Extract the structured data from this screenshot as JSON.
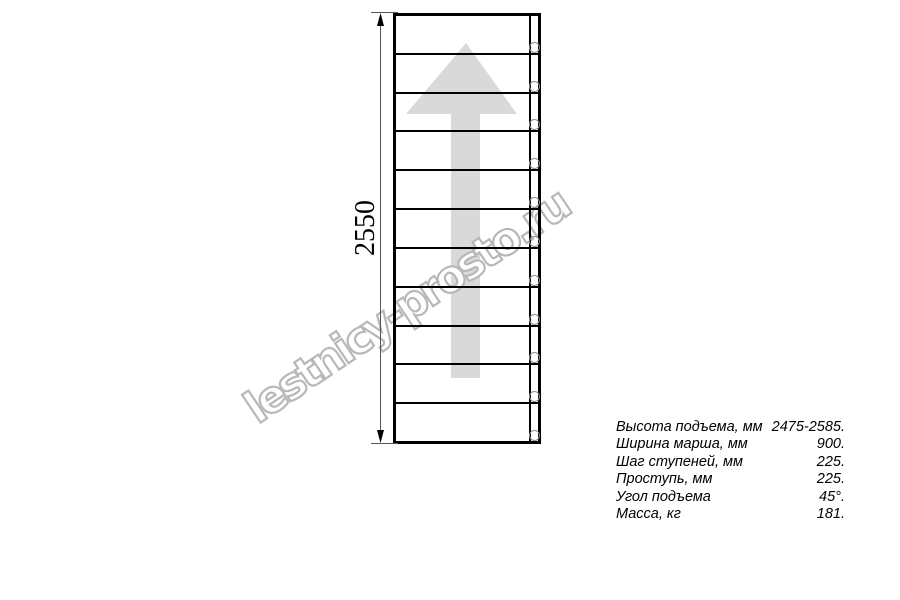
{
  "drawing": {
    "dimension_label": "2550",
    "watermark_text": "lestnicy-prosto.ru",
    "steps_count": 11,
    "bolt_holes_count": 11,
    "direction_arrow_icon": "up-arrow-icon",
    "colors": {
      "linework": "#000000",
      "dimension_line": "#555555",
      "arrow_fill": "#d9d9d9",
      "watermark_stroke": "#b8b8b8",
      "bolt_circle_stroke": "#8f8f8f",
      "background": "#ffffff"
    }
  },
  "spec_table": {
    "rows": [
      {
        "label": "Высота подъема, мм",
        "value": "2475-2585."
      },
      {
        "label": "Ширина марша, мм",
        "value": "900."
      },
      {
        "label": "Шаг ступеней, мм",
        "value": "225."
      },
      {
        "label": "Проступь, мм",
        "value": "225."
      },
      {
        "label": "Угол подъема",
        "value": "45°."
      },
      {
        "label": "Масса, кг",
        "value": "181."
      }
    ]
  }
}
